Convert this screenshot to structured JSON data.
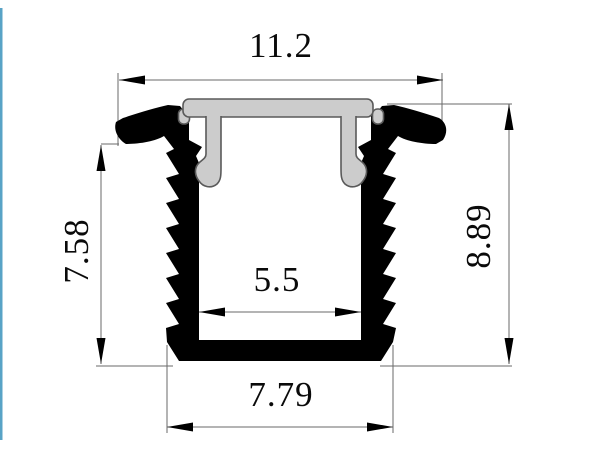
{
  "drawing": {
    "description": "Cross-section technical drawing of a recessed LED aluminium profile with push-in diffuser cover and barbed side walls",
    "dimensions": {
      "top_width": "11.2",
      "body_height": "7.58",
      "overall_height": "8.89",
      "inner_width": "5.5",
      "bottom_width": "7.79"
    },
    "colors": {
      "profile_fill": "#000000",
      "cover_fill": "#cccccc",
      "cover_outline": "#5a5a5a",
      "dimension_line": "#6a6a6a",
      "text": "#0a0a0a",
      "accent_border": "#58a3c6",
      "background": "#ffffff"
    }
  }
}
